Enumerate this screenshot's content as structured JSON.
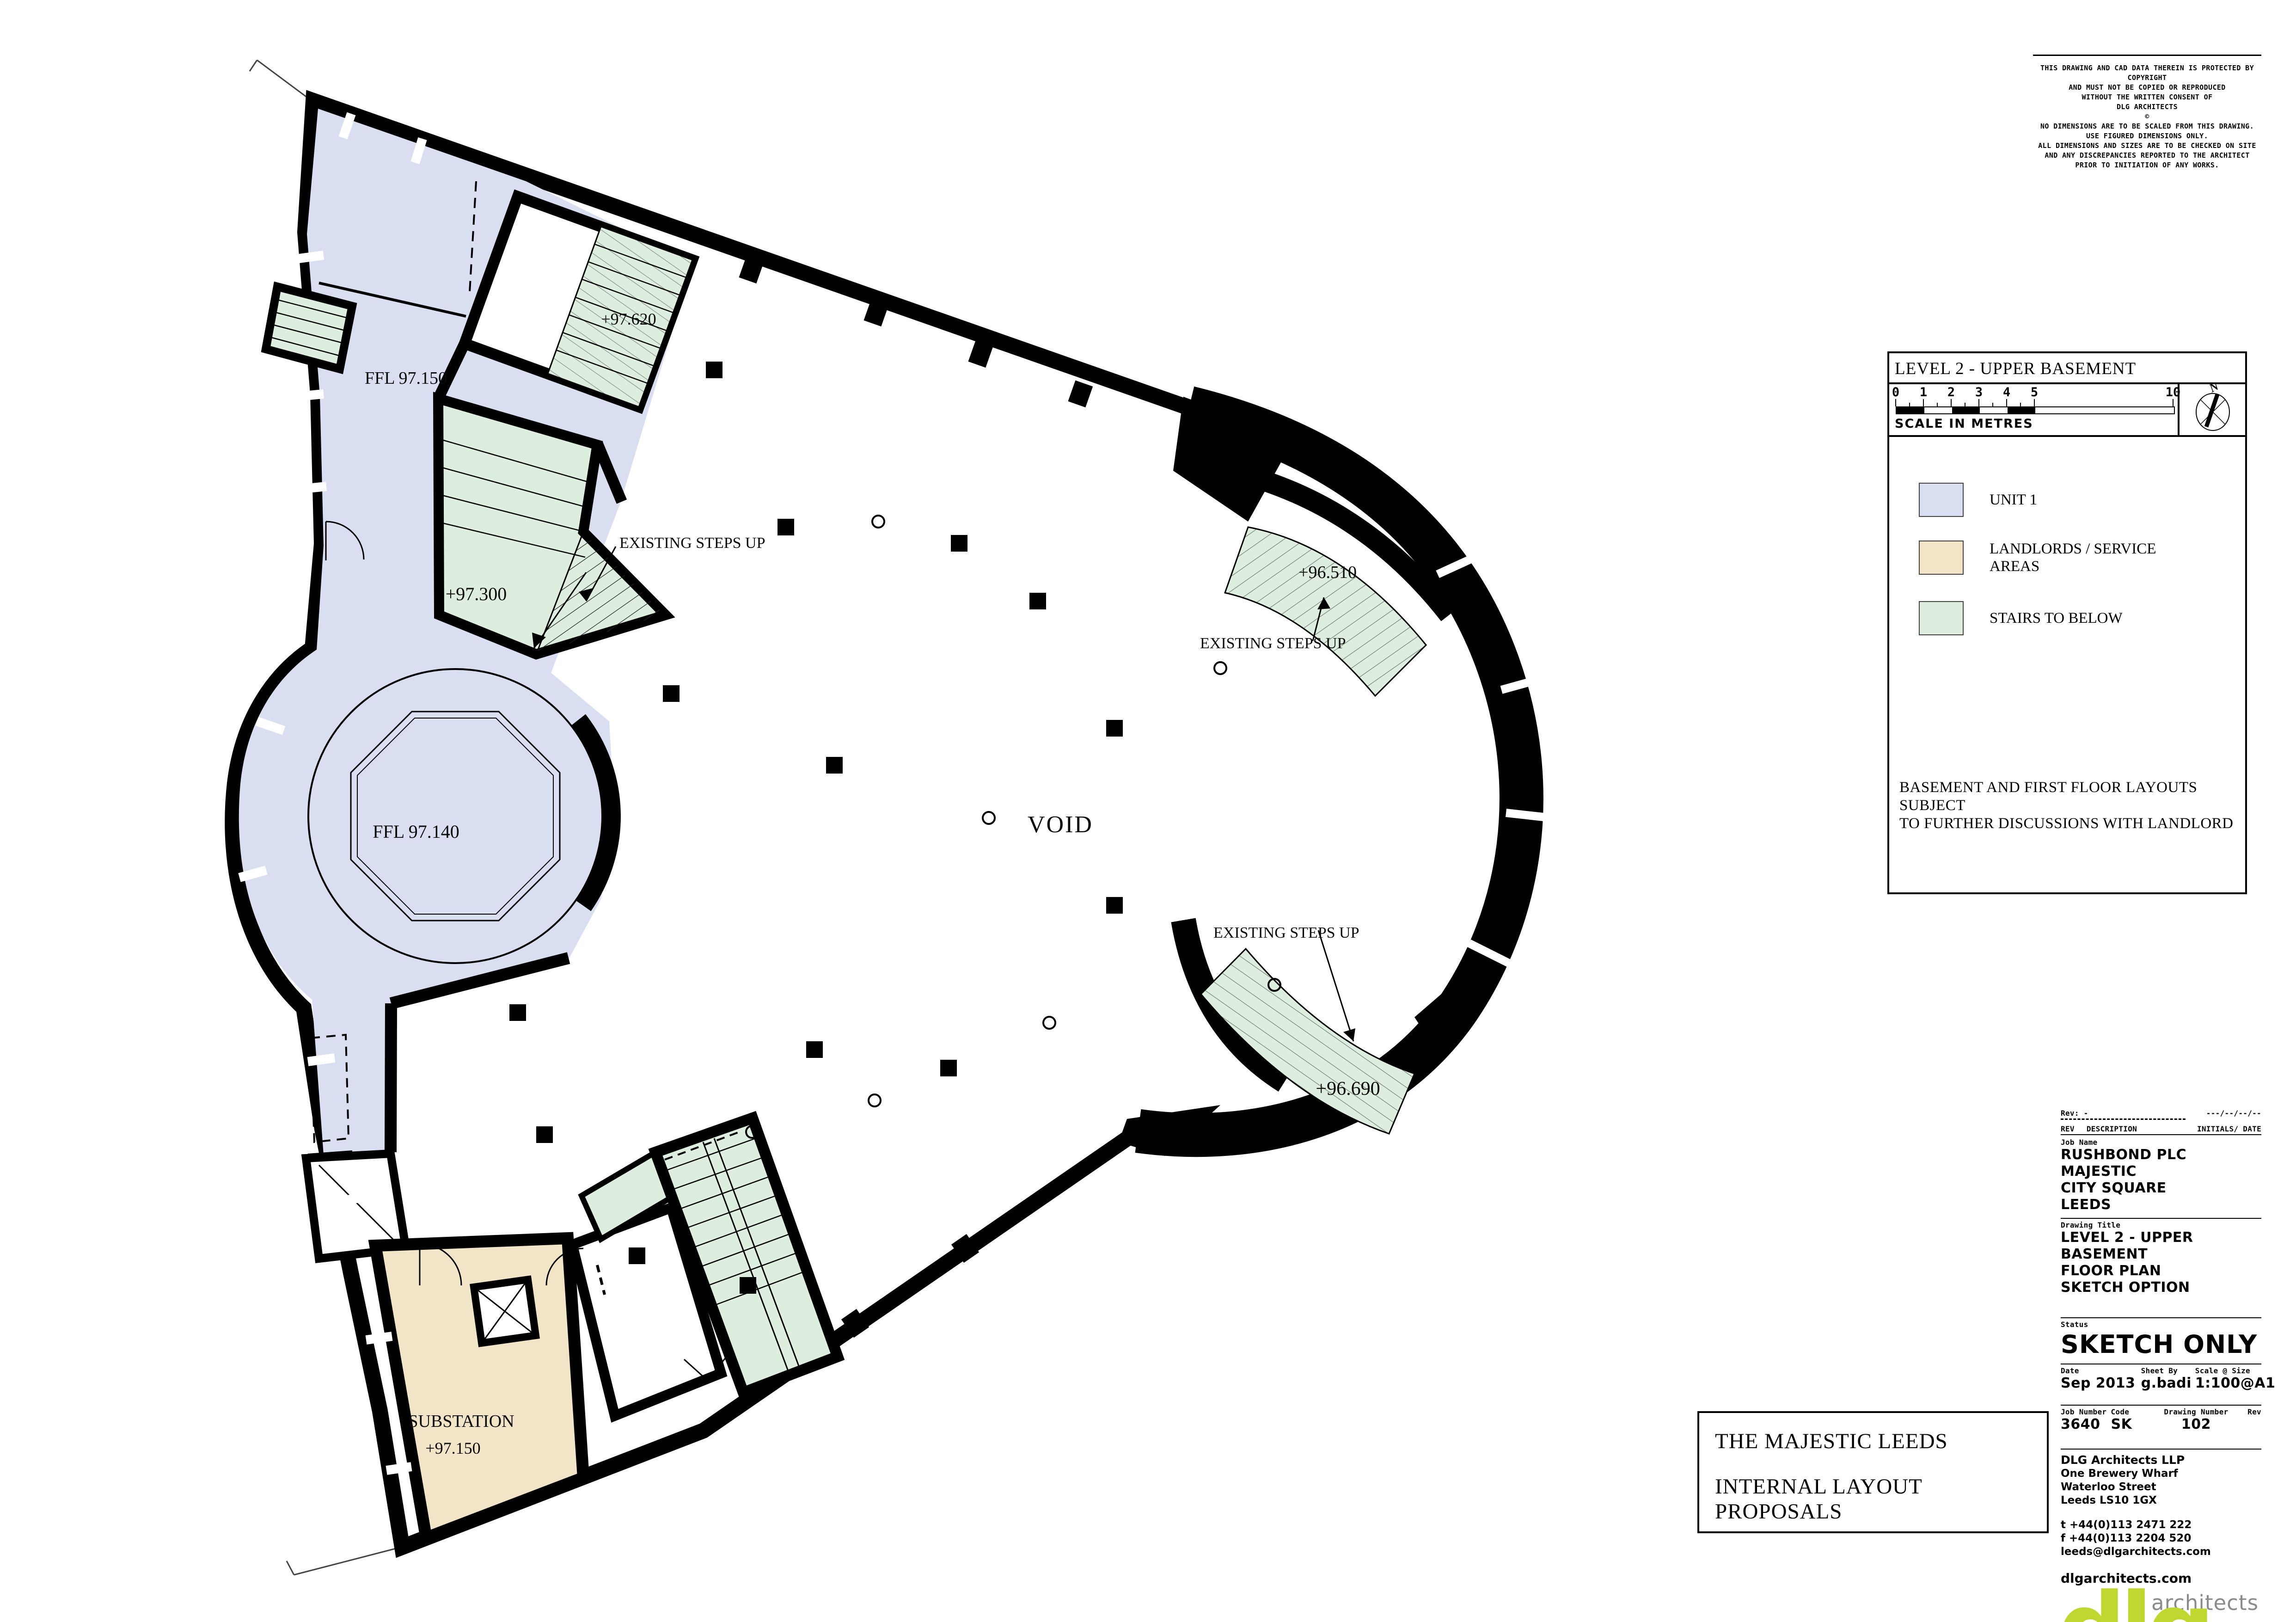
{
  "plan": {
    "labels": {
      "ffl_97_150": "FFL 97.150",
      "level_97_620": "+97.620",
      "steps_up_left": "EXISTING STEPS UP",
      "level_97_300": "+97.300",
      "ffl_97_140": "FFL 97.140",
      "void_label": "VOID",
      "level_96_510": "+96.510",
      "steps_up_top_right": "EXISTING STEPS UP",
      "steps_up_bottom_right": "EXISTING STEPS UP",
      "level_96_690": "+96.690",
      "substation_name": "SUBSTATION",
      "substation_level": "+97.150"
    },
    "colors": {
      "unit1": "#d9dff0",
      "landlords": "#f2e4c6",
      "stairs": "#deeede"
    }
  },
  "copyright": {
    "lines": [
      "THIS DRAWING AND CAD DATA THEREIN IS PROTECTED BY",
      "COPYRIGHT",
      "AND MUST NOT BE COPIED OR REPRODUCED",
      "WITHOUT THE WRITTEN CONSENT OF",
      "DLG ARCHITECTS",
      "©",
      "NO DIMENSIONS ARE TO BE SCALED FROM THIS DRAWING.",
      "USE FIGURED DIMENSIONS ONLY.",
      "ALL DIMENSIONS AND SIZES ARE TO BE CHECKED ON SITE",
      "AND ANY DISCREPANCIES REPORTED TO THE ARCHITECT",
      "PRIOR TO INITIATION OF ANY WORKS."
    ]
  },
  "legend": {
    "title": "LEVEL 2 - UPPER BASEMENT",
    "scale_numbers": [
      "0",
      "1",
      "2",
      "3",
      "4",
      "5",
      "10"
    ],
    "scale_caption": "SCALE IN METRES",
    "north_label": "N",
    "items": [
      {
        "label_line1": "UNIT 1",
        "label_line2": "",
        "color": "#d9dff0"
      },
      {
        "label_line1": "LANDLORDS / SERVICE",
        "label_line2": "AREAS",
        "color": "#f2e4c6"
      },
      {
        "label_line1": "STAIRS TO BELOW",
        "label_line2": "",
        "color": "#deeede"
      }
    ],
    "note_line1": "BASEMENT AND FIRST FLOOR LAYOUTS SUBJECT",
    "note_line2": "TO FURTHER DISCUSSIONS WITH LANDLORD"
  },
  "titleblock": {
    "rev_label": "Rev: -",
    "rev_date_placeholder": "---/--/--/--",
    "rev_header_left": "REV",
    "rev_header_mid": "DESCRIPTION",
    "rev_header_right": "INITIALS/ DATE",
    "job_name_label": "Job Name",
    "job_name_lines": [
      "RUSHBOND PLC",
      "MAJESTIC",
      "CITY SQUARE",
      "LEEDS"
    ],
    "drawing_title_label": "Drawing Title",
    "drawing_title_lines": [
      "LEVEL 2 - UPPER BASEMENT",
      "FLOOR PLAN",
      "SKETCH OPTION"
    ],
    "status_label": "Status",
    "status_value": "SKETCH ONLY",
    "date_label": "Date",
    "date_value": "Sep 2013",
    "sheet_by_label": "Sheet By",
    "sheet_by_value": "g.badi",
    "scale_label": "Scale @ Size",
    "scale_value": "1:100@A1",
    "job_number_label": "Job Number",
    "job_number_value": "3640",
    "code_label": "Code",
    "code_value": "SK",
    "drawing_number_label": "Drawing Number",
    "drawing_number_value": "102",
    "rev_col_label": "Rev",
    "firm_name": "DLG Architects LLP",
    "address_lines": [
      "One Brewery Wharf",
      "Waterloo Street",
      "Leeds LS10 1GX"
    ],
    "tel": "t +44(0)113 2471 222",
    "fax": "f +44(0)113 2204 520",
    "email": "leeds@dlgarchitects.com",
    "website": "dlgarchitects.com",
    "logo_text": "dlg",
    "logo_suffix": "architects",
    "logo_green": "#bfd730"
  },
  "footer_box": {
    "line1": "THE MAJESTIC LEEDS",
    "line2": "INTERNAL LAYOUT PROPOSALS"
  }
}
